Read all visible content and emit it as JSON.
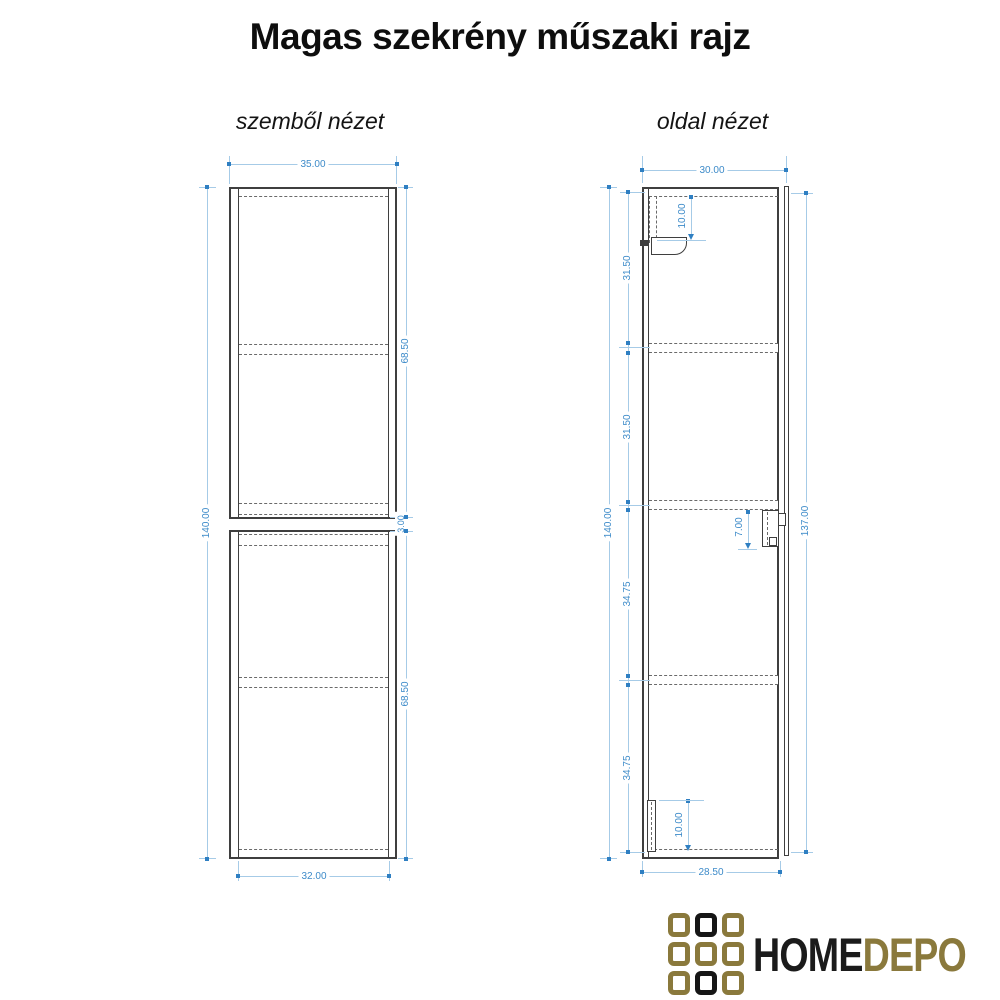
{
  "title": "Magas szekrény műszaki rajz",
  "front_view": {
    "label": "szemből nézet",
    "dimensions": {
      "outer_width": "35.00",
      "total_height": "140.00",
      "upper_section_height": "68.50",
      "middle_gap": "3.00",
      "lower_section_height": "68.50",
      "inner_width": "32.00"
    }
  },
  "side_view": {
    "label": "oldal nézet",
    "dimensions": {
      "outer_depth": "30.00",
      "total_height": "140.00",
      "segment_1": "31.50",
      "segment_2": "31.50",
      "segment_3": "34.75",
      "segment_4": "34.75",
      "door_height": "137.00",
      "top_bracket_offset": "10.00",
      "handle_length": "7.00",
      "bottom_bracket_height": "10.00",
      "inner_depth": "28.50"
    }
  },
  "logo": {
    "text_primary": "HOME",
    "text_secondary": "DEPO",
    "grid_pattern": [
      "gold",
      "black",
      "gold",
      "gold",
      "gold",
      "gold",
      "gold",
      "black",
      "gold"
    ]
  },
  "colors": {
    "dimension_text": "#3d8bc9",
    "dimension_line": "#a6cbe7",
    "dimension_tick": "#2f7fc2",
    "drawing_line": "#3f3f3f",
    "logo_gold": "#8a793c",
    "logo_black": "#161616"
  }
}
